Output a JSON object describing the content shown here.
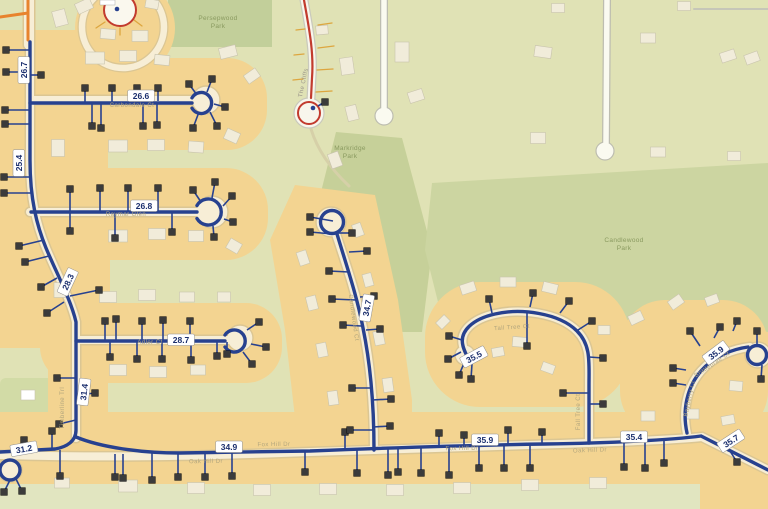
{
  "parks": [
    {
      "name": "Persepwood Park",
      "x": 218,
      "y": 20
    },
    {
      "name": "Markridge Park",
      "x": 350,
      "y": 150
    },
    {
      "name": "Candlewood Park",
      "x": 624,
      "y": 242
    }
  ],
  "street_names": [
    {
      "name": "Carbondale Ct",
      "x": 132,
      "y": 107,
      "rot": 0
    },
    {
      "name": "Raymar Glen",
      "x": 126,
      "y": 216,
      "rot": 0
    },
    {
      "name": "Adler Ct",
      "x": 150,
      "y": 344,
      "rot": 0
    },
    {
      "name": "Timberline Trl",
      "x": 64,
      "y": 408,
      "rot": -90
    },
    {
      "name": "Oak Hill Dr",
      "x": 206,
      "y": 463,
      "rot": -1
    },
    {
      "name": "Fox Hill Dr",
      "x": 274,
      "y": 446,
      "rot": -1
    },
    {
      "name": "Fox Hill Dr",
      "x": 462,
      "y": 450,
      "rot": -1
    },
    {
      "name": "Oak Hill Dr",
      "x": 590,
      "y": 452,
      "rot": -2
    },
    {
      "name": "Candlewood Ct",
      "x": 352,
      "y": 318,
      "rot": 82
    },
    {
      "name": "Tall Tree Ct",
      "x": 512,
      "y": 329,
      "rot": -4
    },
    {
      "name": "Fall Tree Ct",
      "x": 580,
      "y": 412,
      "rot": -90
    },
    {
      "name": "Brittlebrae Ct",
      "x": 713,
      "y": 366,
      "rot": -34
    },
    {
      "name": "Bayberry Ct",
      "x": 691,
      "y": 399,
      "rot": -78
    },
    {
      "name": "The Cliffs",
      "x": 305,
      "y": 83,
      "rot": -78,
      "muted": true
    }
  ],
  "measurements": [
    {
      "value": "26.7",
      "x": 24,
      "y": 70,
      "rot": -90
    },
    {
      "value": "26.6",
      "x": 141,
      "y": 96,
      "rot": 0
    },
    {
      "value": "25.4",
      "x": 19,
      "y": 163,
      "rot": -90
    },
    {
      "value": "26.8",
      "x": 144,
      "y": 206,
      "rot": 0
    },
    {
      "value": "28.3",
      "x": 68,
      "y": 282,
      "rot": -65
    },
    {
      "value": "28.7",
      "x": 181,
      "y": 340,
      "rot": 0
    },
    {
      "value": "31.4",
      "x": 84,
      "y": 392,
      "rot": -83
    },
    {
      "value": "31.2",
      "x": 24,
      "y": 449,
      "rot": -10
    },
    {
      "value": "34.9",
      "x": 229,
      "y": 447,
      "rot": 0
    },
    {
      "value": "34.7",
      "x": 367,
      "y": 308,
      "rot": -80
    },
    {
      "value": "35.5",
      "x": 474,
      "y": 357,
      "rot": -28
    },
    {
      "value": "35.9",
      "x": 485,
      "y": 440,
      "rot": 0
    },
    {
      "value": "35.4",
      "x": 634,
      "y": 437,
      "rot": 0
    },
    {
      "value": "35.9",
      "x": 716,
      "y": 353,
      "rot": -37
    },
    {
      "value": "35.7",
      "x": 731,
      "y": 441,
      "rot": -33
    }
  ],
  "colors": {
    "base": "#e0e2b5",
    "park_green": "#c6d099",
    "residential_tan": "#f3d491",
    "street_cream": "#f7eed6",
    "street_casing": "#dbc693",
    "pipe_blue": "#27418f",
    "marker_dark": "#3b3b3b",
    "road_red": "#c23b2e",
    "road_orange": "#e8832d",
    "label_navy": "#1b2f6e"
  }
}
